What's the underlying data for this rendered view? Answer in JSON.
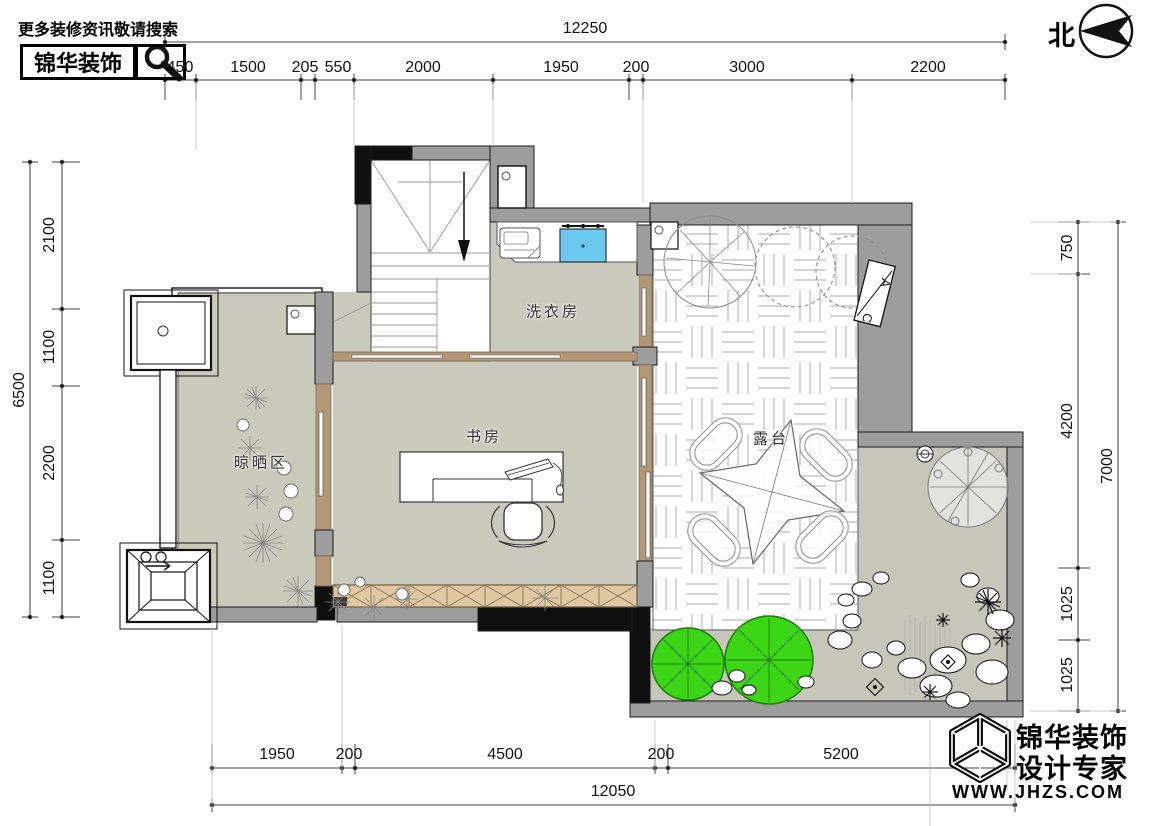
{
  "header": {
    "tagline": "更多装修资讯敬请搜索",
    "brand": "锦华装饰"
  },
  "compass": {
    "label": "北"
  },
  "rooms": {
    "laundry": "洗衣房",
    "study": "书房",
    "terrace": "露台",
    "drying": "晾晒区"
  },
  "elevation_marker": {
    "top": "A",
    "bottom": "C"
  },
  "dimensions": {
    "top": {
      "total": "12250",
      "segments": [
        "450",
        "1500",
        "205",
        "550",
        "2000",
        "1950",
        "200",
        "3000",
        "2200"
      ]
    },
    "left": {
      "total": "6500",
      "segments": [
        "2100",
        "1100",
        "2200",
        "1100"
      ]
    },
    "right": {
      "total": "7000",
      "segments": [
        "750",
        "4200",
        "1025",
        "1025"
      ]
    },
    "bottom": {
      "total": "12050",
      "segments": [
        "1950",
        "200",
        "4500",
        "200",
        "5200"
      ]
    }
  },
  "footer": {
    "brand": "锦华装饰",
    "subtitle": "设计专家",
    "website": "WWW.JHZS.COM"
  },
  "colors": {
    "wall": "#9d9d9d",
    "black_wall": "#0f0f0f",
    "floor": "#c9c9bc",
    "door_band": "#b39877",
    "cabinet": "#e0c8a2",
    "sink": "#6bc8ef",
    "tree_green": "#3cd616"
  }
}
